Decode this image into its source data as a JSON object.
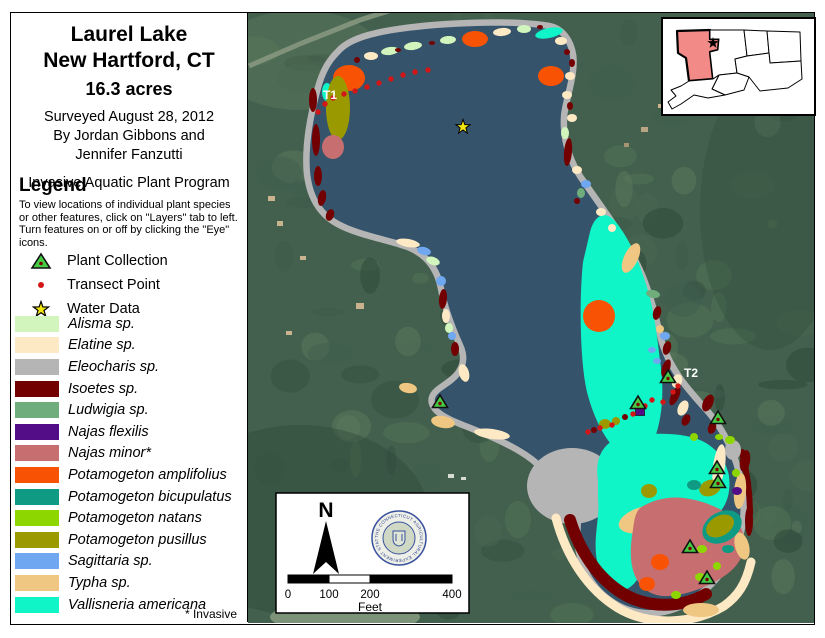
{
  "palette": {
    "alisma": "#d2f5bd",
    "elatine": "#fde9c4",
    "eleocharis": "#b5b5b5",
    "isoetes": "#730000",
    "ludwigia": "#6fae7c",
    "nflex": "#520d87",
    "nminor": "#c76e70",
    "pampl": "#f85204",
    "pbicu": "#0f9a84",
    "pnat": "#8ed600",
    "ppus": "#9a9a00",
    "sagittaria": "#6fa8f0",
    "typha": "#efc782",
    "vallis": "#10f5c8",
    "lake": "#35536b",
    "land": "#42604d",
    "shore": "#b5b5b5",
    "road": "#87977f",
    "marker_green": "#44cc44",
    "marker_dot": "#7a0000",
    "transect_red": "#d31717",
    "star_yellow": "#f2e50e",
    "inset_highlight": "#f28b88",
    "seal_blue": "#2b3f8f"
  },
  "panel": {
    "title_lines": [
      "Laurel Lake",
      "New Hartford, CT",
      "16.3 acres"
    ],
    "credit_lines": [
      "Surveyed August 28, 2012",
      "By Jordan Gibbons and",
      "Jennifer Fanzutti"
    ],
    "program": "Invasive Aquatic Plant Program",
    "legend": {
      "heading": "Legend",
      "note_lines": [
        "To view locations of individual plant species",
        "or other features, click on \"Layers\" tab to left.",
        "Turn features on or off by clicking the \"Eye\"",
        "icons."
      ],
      "point_items": [
        {
          "name": "plant-collection",
          "label": "Plant Collection"
        },
        {
          "name": "transect-point",
          "label": "Transect Point"
        },
        {
          "name": "water-data",
          "label": "Water Data"
        }
      ],
      "species": [
        {
          "key": "alisma",
          "label": "Alisma sp."
        },
        {
          "key": "elatine",
          "label": "Elatine sp."
        },
        {
          "key": "eleocharis",
          "label": "Eleocharis sp."
        },
        {
          "key": "isoetes",
          "label": "Isoetes sp."
        },
        {
          "key": "ludwigia",
          "label": "Ludwigia sp."
        },
        {
          "key": "nflex",
          "label": "Najas flexilis"
        },
        {
          "key": "nminor",
          "label": "Najas minor*"
        },
        {
          "key": "pampl",
          "label": "Potamogeton amplifolius"
        },
        {
          "key": "pbicu",
          "label": "Potamogeton bicupulatus"
        },
        {
          "key": "pnat",
          "label": "Potamogeton natans"
        },
        {
          "key": "ppus",
          "label": "Potamogeton pusillus"
        },
        {
          "key": "sagittaria",
          "label": "Sagittaria sp."
        },
        {
          "key": "typha",
          "label": "Typha sp."
        },
        {
          "key": "vallis",
          "label": "Vallisneria americana"
        }
      ],
      "invasive_note": "* Invasive"
    }
  },
  "map": {
    "labels": [
      {
        "text": "T1",
        "x": 323,
        "y": 99
      },
      {
        "text": "T2",
        "x": 684,
        "y": 377
      }
    ],
    "lake_path": "M340,54 C350,42 372,36 400,32 C442,26 512,23 548,29 C560,31 568,42 570,56 C572,74 564,94 561,114 C559,137 565,159 578,179 C596,205 618,234 632,261 C646,288 652,315 659,344 C668,372 686,392 704,412 C718,428 729,448 735,470 C741,492 743,516 736,538 C727,566 706,590 680,603 C657,614 631,612 611,597 C594,585 583,564 581,544 C579,527 585,511 576,499 C566,486 549,469 534,457 C517,444 494,434 469,424 C451,417 437,411 435,402 C433,393 447,389 457,379 C467,369 469,357 463,344 C454,324 447,304 444,287 C440,267 429,252 409,244 C387,236 359,232 339,221 C321,211 312,194 310,171 C308,144 314,114 321,89 C326,71 332,62 340,54 Z",
    "regions": {
      "vallisneria_mid": "M590,232 C594,216 604,210 614,220 C630,238 642,268 650,298 C656,322 658,346 661,368 C664,394 662,420 654,440 C648,456 636,462 622,454 C608,446 594,420 587,392 C580,362 579,300 583,262 Z",
      "vallisneria_south": "M598,480 C594,455 606,438 628,436 C652,433 680,432 700,440 C716,447 726,460 729,476 C731,492 727,505 718,514 C708,524 694,530 680,538 C664,547 650,558 642,572 C636,583 628,592 618,590 C606,587 598,572 596,554 C594,534 600,516 598,498 Z",
      "najas_minor_bed": "M640,508 C652,500 668,496 684,498 C700,500 716,506 728,514 C740,522 746,534 744,548 C742,562 732,572 718,580 C704,588 686,595 668,596 C654,597 642,590 636,578 C630,566 630,550 632,536 C634,524 634,514 640,508 Z",
      "elatine_band": "M556,518 C566,556 588,590 618,608 C650,627 694,624 724,606 C738,596 746,584 751,562",
      "isoetes_band": "M570,520 C580,552 598,578 622,593 C648,609 682,608 706,594",
      "isoetes_segment": "M742,452 C747,472 750,492 750,514"
    },
    "gray_bed": {
      "x": 572,
      "y": 486,
      "rx": 45,
      "ry": 38
    },
    "typha_crescent": {
      "x": 646,
      "y": 519,
      "rx": 28,
      "ry": 13,
      "rot": -15,
      "inner_rx": 18,
      "inner_ry": 7
    },
    "amplifolius_circle": {
      "x": 599,
      "y": 316,
      "r": 16
    },
    "patches": [
      [
        "elatine",
        719,
        466,
        6,
        22,
        8
      ],
      [
        "typha",
        740,
        491,
        6,
        18,
        5
      ],
      [
        "eleocharis",
        733,
        450,
        8,
        10,
        0
      ],
      [
        "isoetes",
        745,
        461,
        5,
        11,
        10
      ],
      [
        "isoetes",
        749,
        521,
        4,
        15,
        0
      ],
      [
        "typha",
        742,
        546,
        7,
        14,
        -15
      ],
      [
        "typha",
        701,
        610,
        18,
        7,
        0
      ],
      [
        "elatine",
        371,
        56,
        7,
        4,
        0
      ],
      [
        "alisma",
        390,
        51,
        9,
        4,
        -8
      ],
      [
        "alisma",
        413,
        46,
        9,
        4,
        -8
      ],
      [
        "isoetes",
        357,
        60,
        3,
        3,
        0
      ],
      [
        "isoetes",
        398,
        50,
        3,
        2,
        0
      ],
      [
        "isoetes",
        432,
        43,
        3,
        2,
        0
      ],
      [
        "alisma",
        448,
        40,
        8,
        4,
        -5
      ],
      [
        "pampl",
        475,
        39,
        13,
        8,
        0
      ],
      [
        "elatine",
        502,
        32,
        9,
        4,
        -5
      ],
      [
        "alisma",
        524,
        29,
        7,
        4,
        0
      ],
      [
        "isoetes",
        540,
        27,
        3,
        2,
        0
      ],
      [
        "vallis",
        549,
        33,
        14,
        5,
        -12
      ],
      [
        "elatine",
        561,
        41,
        6,
        4,
        0
      ],
      [
        "isoetes",
        567,
        52,
        3,
        3,
        0
      ],
      [
        "isoetes",
        572,
        63,
        3,
        4,
        0
      ],
      [
        "elatine",
        570,
        76,
        5,
        4,
        0
      ],
      [
        "pampl",
        551,
        76,
        13,
        10,
        0
      ],
      [
        "elatine",
        567,
        95,
        5,
        4,
        0
      ],
      [
        "isoetes",
        570,
        106,
        3,
        4,
        0
      ],
      [
        "elatine",
        572,
        118,
        5,
        4,
        0
      ],
      [
        "alisma",
        565,
        133,
        4,
        6,
        0
      ],
      [
        "isoetes",
        568,
        152,
        4,
        14,
        5
      ],
      [
        "elatine",
        577,
        170,
        5,
        4,
        0
      ],
      [
        "sagittaria",
        586,
        184,
        5,
        4,
        0
      ],
      [
        "ludwigia",
        581,
        193,
        4,
        5,
        0
      ],
      [
        "isoetes",
        577,
        201,
        3,
        3,
        0
      ],
      [
        "elatine",
        601,
        212,
        5,
        4,
        0
      ],
      [
        "elatine",
        612,
        228,
        4,
        4,
        0
      ],
      [
        "typha",
        631,
        258,
        7,
        16,
        25
      ],
      [
        "ludwigia",
        653,
        294,
        7,
        4,
        10
      ],
      [
        "isoetes",
        657,
        313,
        4,
        7,
        15
      ],
      [
        "typha",
        660,
        329,
        4,
        4,
        0
      ],
      [
        "sagittaria",
        665,
        336,
        5,
        4,
        0
      ],
      [
        "isoetes",
        667,
        348,
        4,
        7,
        15
      ],
      [
        "sagittaria",
        652,
        350,
        4,
        3,
        0
      ],
      [
        "sagittaria",
        657,
        361,
        4,
        3,
        0
      ],
      [
        "isoetes",
        666,
        368,
        4,
        9,
        20
      ],
      [
        "elatine",
        677,
        381,
        5,
        7,
        20
      ],
      [
        "isoetes",
        675,
        396,
        4,
        10,
        25
      ],
      [
        "elatine",
        683,
        408,
        5,
        8,
        25
      ],
      [
        "isoetes",
        686,
        420,
        4,
        6,
        25
      ],
      [
        "isoetes",
        708,
        403,
        5,
        9,
        25
      ],
      [
        "isoetes",
        712,
        428,
        4,
        6,
        20
      ],
      [
        "vallis",
        327,
        92,
        5,
        9,
        0
      ],
      [
        "isoetes",
        313,
        100,
        4,
        12,
        0
      ],
      [
        "isoetes",
        316,
        140,
        4,
        16,
        0
      ],
      [
        "isoetes",
        318,
        176,
        4,
        10,
        0
      ],
      [
        "isoetes",
        322,
        198,
        4,
        8,
        10
      ],
      [
        "pampl",
        349,
        78,
        16,
        13,
        0
      ],
      [
        "ppus",
        338,
        108,
        12,
        32,
        0
      ],
      [
        "nminor",
        333,
        147,
        11,
        12,
        0
      ],
      [
        "isoetes",
        330,
        215,
        4,
        6,
        20
      ],
      [
        "elatine",
        408,
        243,
        12,
        4,
        10
      ],
      [
        "sagittaria",
        424,
        251,
        7,
        4,
        15
      ],
      [
        "alisma",
        433,
        261,
        7,
        4,
        20
      ],
      [
        "sagittaria",
        441,
        281,
        5,
        5,
        0
      ],
      [
        "isoetes",
        443,
        299,
        4,
        10,
        5
      ],
      [
        "elatine",
        446,
        316,
        4,
        7,
        0
      ],
      [
        "alisma",
        449,
        328,
        4,
        5,
        0
      ],
      [
        "sagittaria",
        452,
        336,
        4,
        4,
        0
      ],
      [
        "isoetes",
        455,
        349,
        4,
        7,
        0
      ],
      [
        "elatine",
        464,
        373,
        5,
        9,
        -15
      ],
      [
        "typha",
        408,
        388,
        9,
        5,
        10
      ],
      [
        "typha",
        443,
        422,
        12,
        6,
        10
      ],
      [
        "elatine",
        492,
        434,
        18,
        5,
        8
      ],
      [
        "ppus",
        605,
        424,
        6,
        5,
        0
      ],
      [
        "isoetes",
        594,
        430,
        3,
        3,
        0
      ],
      [
        "ppus",
        616,
        421,
        4,
        4,
        0
      ],
      [
        "isoetes",
        625,
        417,
        3,
        3,
        0
      ],
      [
        "pnat",
        694,
        437,
        4,
        4,
        0
      ],
      [
        "pnat",
        730,
        440,
        5,
        4,
        0
      ],
      [
        "pnat",
        719,
        437,
        4,
        3,
        0
      ],
      [
        "nflex",
        737,
        491,
        5,
        4,
        0
      ],
      [
        "ppus",
        710,
        488,
        11,
        8,
        -20
      ],
      [
        "ppus",
        649,
        491,
        8,
        7,
        0
      ],
      [
        "pbicu",
        694,
        485,
        7,
        5,
        0
      ],
      [
        "pbicu",
        722,
        527,
        21,
        15,
        -30
      ],
      [
        "ppus",
        720,
        526,
        15,
        10,
        -30
      ],
      [
        "pampl",
        660,
        562,
        9,
        8,
        0
      ],
      [
        "pampl",
        647,
        584,
        8,
        7,
        0
      ],
      [
        "pnat",
        676,
        595,
        5,
        4,
        0
      ],
      [
        "pnat",
        700,
        577,
        5,
        4,
        0
      ],
      [
        "pnat",
        717,
        566,
        4,
        4,
        0
      ],
      [
        "pnat",
        702,
        549,
        5,
        4,
        0
      ],
      [
        "pnat",
        736,
        473,
        4,
        4,
        0
      ],
      [
        "pbicu",
        728,
        549,
        6,
        4,
        0
      ]
    ],
    "transect_dots": [
      [
        333,
        98
      ],
      [
        344,
        94
      ],
      [
        355,
        91
      ],
      [
        367,
        87
      ],
      [
        379,
        83
      ],
      [
        391,
        79
      ],
      [
        403,
        75
      ],
      [
        415,
        72
      ],
      [
        428,
        70
      ],
      [
        318,
        112
      ],
      [
        325,
        104
      ],
      [
        588,
        432
      ],
      [
        600,
        428
      ],
      [
        612,
        425
      ],
      [
        633,
        414
      ],
      [
        645,
        406
      ],
      [
        652,
        400
      ],
      [
        663,
        402
      ],
      [
        673,
        392
      ],
      [
        678,
        386
      ]
    ],
    "collection_points": [
      [
        440,
        402
      ],
      [
        668,
        377
      ],
      [
        638,
        403
      ],
      [
        718,
        418
      ],
      [
        717,
        468
      ],
      [
        718,
        482
      ],
      [
        690,
        547
      ],
      [
        707,
        578
      ]
    ],
    "najas_flexilis_squares": [
      [
        640,
        411
      ]
    ],
    "water_data_star": {
      "x": 463,
      "y": 127
    },
    "roads": [
      "M249,66 L302,43 L360,20 L404,6"
    ],
    "land_marks": [
      {
        "x": 268,
        "y": 196,
        "w": 7,
        "h": 5,
        "c": "#c9b48e"
      },
      {
        "x": 277,
        "y": 221,
        "w": 6,
        "h": 5,
        "c": "#c9b48e"
      },
      {
        "x": 300,
        "y": 256,
        "w": 6,
        "h": 4,
        "c": "#c9b48e"
      },
      {
        "x": 356,
        "y": 303,
        "w": 8,
        "h": 6,
        "c": "#c9b48e"
      },
      {
        "x": 308,
        "y": 183,
        "w": 5,
        "h": 4,
        "c": "#b9a584"
      },
      {
        "x": 641,
        "y": 127,
        "w": 7,
        "h": 5,
        "c": "#b9a584"
      },
      {
        "x": 658,
        "y": 104,
        "w": 5,
        "h": 4,
        "c": "#c9b48e"
      },
      {
        "x": 624,
        "y": 143,
        "w": 5,
        "h": 4,
        "c": "#a89274"
      },
      {
        "x": 448,
        "y": 474,
        "w": 6,
        "h": 4,
        "c": "#d8dcd2"
      },
      {
        "x": 461,
        "y": 477,
        "w": 5,
        "h": 3,
        "c": "#d8dcd2"
      },
      {
        "x": 286,
        "y": 331,
        "w": 6,
        "h": 4,
        "c": "#c9b48e"
      }
    ],
    "inset": {
      "counties": [
        {
          "d": "M677,31 L710,30 L710,39 L719,39 L718,50 L710,52 L713,79 L689,81 L686,58 L678,53 Z",
          "hl": true
        },
        {
          "d": "M710,30 L744,30 L747,56 L735,59 L737,73 L719,75 L713,79 L710,52 L718,50 L719,39 L710,39 Z"
        },
        {
          "d": "M744,30 L767,31 L769,53 L747,56 Z"
        },
        {
          "d": "M767,31 L800,32 L801,61 L770,63 L769,53 Z"
        },
        {
          "d": "M747,56 L769,53 L770,63 L801,61 L802,79 L788,88 L760,91 L749,77 L737,73 L735,59 Z"
        },
        {
          "d": "M719,75 L737,73 L749,77 L744,90 L725,95 L712,89 Z"
        },
        {
          "d": "M689,81 L713,79 L719,75 L712,89 L725,95 L708,98 L694,95 L681,104 L672,109 L668,102 L676,96 L671,90 L681,86 Z"
        }
      ],
      "star": {
        "x": 713,
        "y": 43
      }
    },
    "scale": {
      "north_label": "N",
      "ticks": [
        "0",
        "100",
        "200",
        "400"
      ],
      "tick_x": [
        288,
        329,
        370,
        452
      ],
      "unit": "Feet",
      "seal_text": "THE CONNECTICUT AGRICULTURAL EXPERIMENT STATION"
    }
  }
}
